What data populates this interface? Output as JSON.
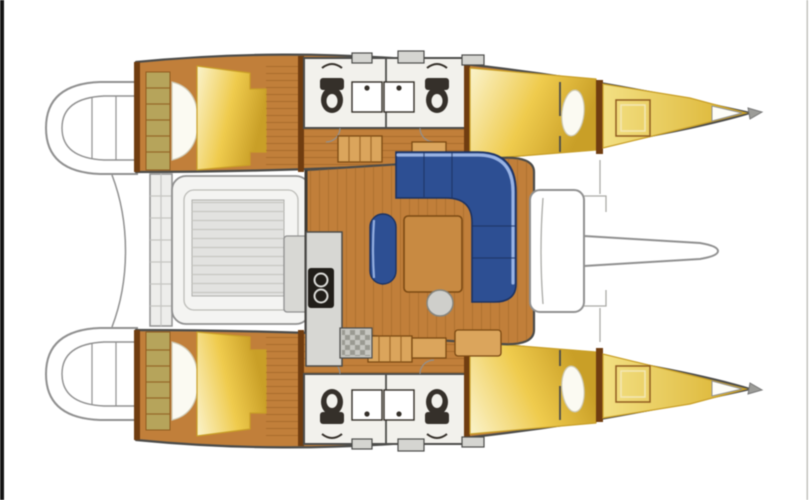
{
  "meta": {
    "type": "diagram",
    "subject": "catamaran-interior-layout-top-view",
    "description": "Top-down interior layout plan of a four-cabin sailing catamaran with central salon, aft cockpit, twin hulls and bowsprit"
  },
  "colors": {
    "page_bg": "#ffffff",
    "frame_left": "#151515",
    "frame_right": "#b8b8b4",
    "line_dark": "#4c4c4a",
    "line_soft": "#909090",
    "hull_wood": "#bf7f3d",
    "plank_line": "#8f5c22",
    "bulkhead_wood": "#6e3d12",
    "bed_yellow": "#eecb52",
    "bed_yellow_light": "#faf3cd",
    "bed_shadow": "#c79f2c",
    "pillow_white": "#fbfaf2",
    "forepeak_yellow": "#f2e087",
    "forepeak_deep": "#d9b132",
    "head_floor": "#f2f1ec",
    "fixture_dark": "#35302a",
    "sink_white": "#ffffff",
    "sofa_blue": "#2e4f90",
    "sofa_blue_light": "#a0b8e6",
    "sofa_blue_dark": "#1d3260",
    "table_wood": "#c68a45",
    "table_edge": "#7a4a16",
    "cockpit_deck": "#ededeb",
    "cockpit_pad": "#e2e2e0",
    "cockpit_line": "#c6c6c2",
    "counter_gray": "#d7d7d3",
    "steps_khaki": "#b5a45e",
    "cabinet_tan": "#d9a55f",
    "pouf_gray": "#cfcfcb",
    "deck_hatch_gray": "#d5d5d1"
  },
  "features": {
    "hulls": [
      "port-hull",
      "starboard-hull"
    ],
    "per_hull": [
      "stern-platform",
      "cabin-steps",
      "aft-cabin-bed",
      "bed-pillow",
      "bathrooms",
      "toilet",
      "sink",
      "hull-corridor",
      "forward-cabin-bed",
      "forepeak-berth",
      "forepeak-hatch",
      "deck-hatch",
      "bow-fitting"
    ],
    "center": [
      "transom-platform",
      "cockpit-bench",
      "cockpit-table-pad",
      "cockpit-table",
      "salon-floor",
      "galley-counter",
      "galley-stove",
      "galley-sink",
      "companionway-steps",
      "cabinet",
      "salon-sofa",
      "salon-table",
      "salon-bench",
      "salon-stool",
      "forward-crossbeam",
      "bowsprit"
    ]
  }
}
